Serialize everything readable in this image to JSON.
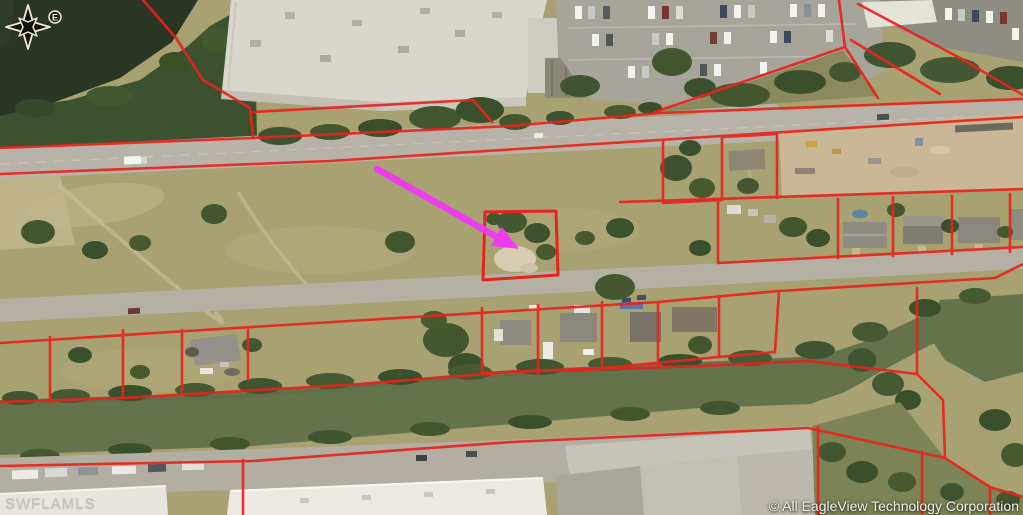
{
  "map": {
    "type": "aerial-parcel-map",
    "watermark_left": "SWFLAMLS",
    "copyright_notice": "© All EagleView Technology Corporation",
    "compass": {
      "label": "E"
    },
    "colors": {
      "parcel_line": "#e8231e",
      "pointer_arrow": "#ee3cee",
      "pond_water": "#2a3524",
      "canal_water": "#64734c",
      "grass": "#a8a172",
      "road": "#b7b3a8",
      "dirt": "#c9b795"
    }
  }
}
